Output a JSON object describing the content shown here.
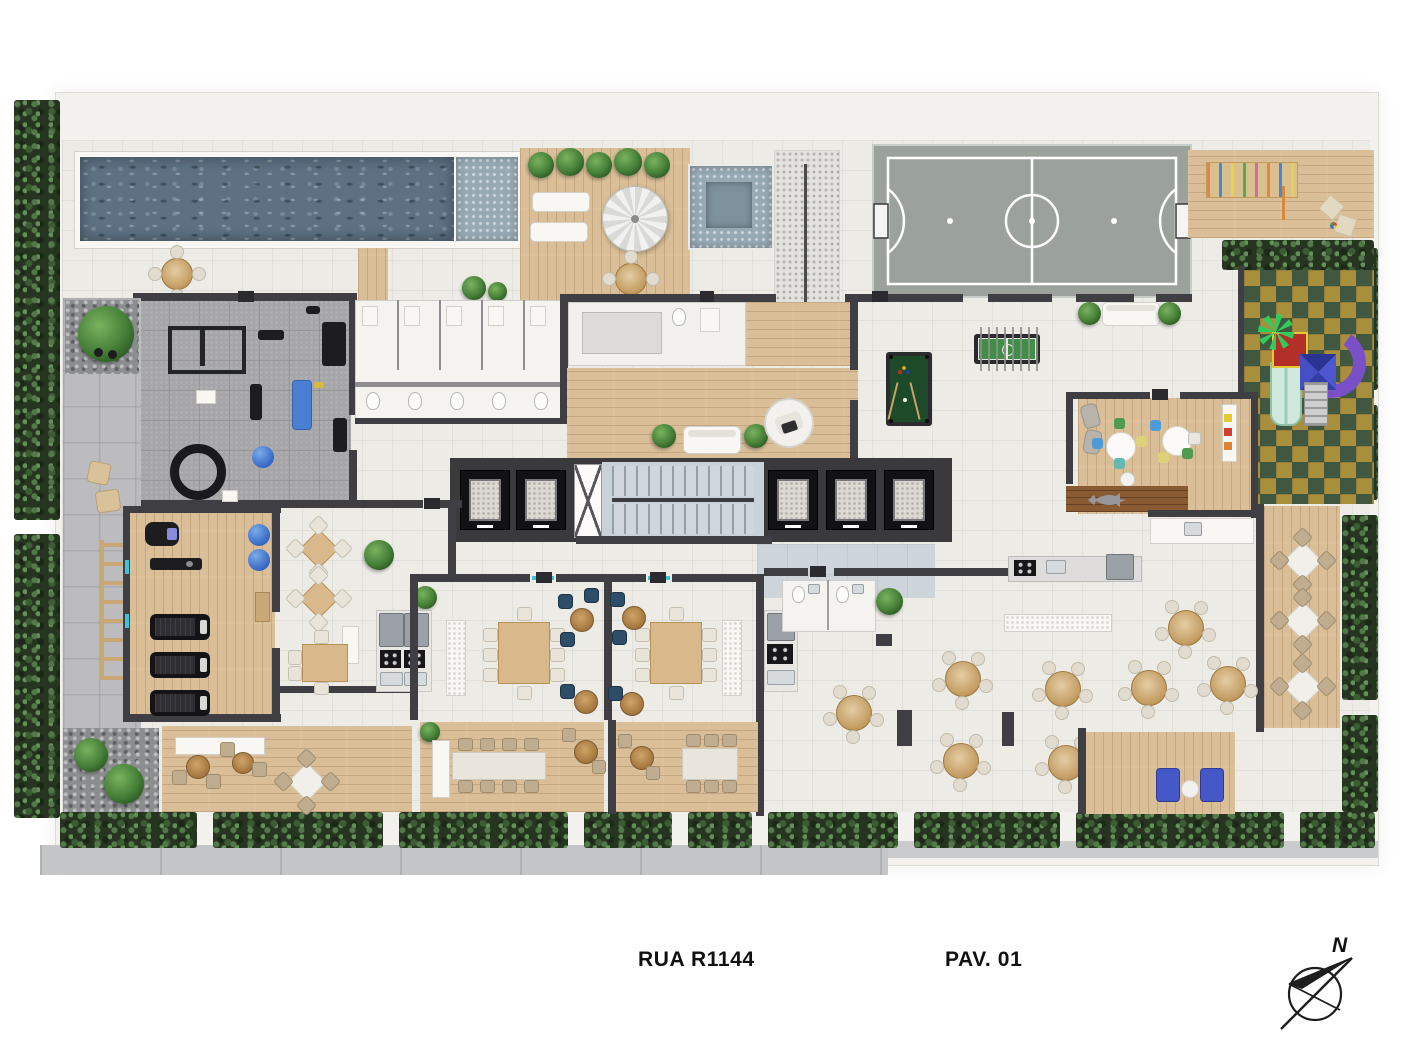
{
  "labels": {
    "street": "RUA R1144",
    "floor": "PAV. 01",
    "compass_north": "N"
  },
  "plan": {
    "type": "residential-amenities-floor-plan",
    "level": "ground floor",
    "areas": [
      "swimming-pool",
      "pool-shallow-ledge",
      "pool-deck",
      "sun-deck",
      "spa-pool",
      "access-ramp",
      "sports-court",
      "multipurpose-room",
      "playground",
      "planter",
      "gym",
      "outdoor-gym",
      "locker-rooms",
      "sauna",
      "lounge",
      "elevator-core",
      "stairwell",
      "entrance-lobby",
      "game-area",
      "billiards",
      "foosball",
      "kids-room",
      "cardio-room",
      "gourmet-room",
      "party-room-1",
      "party-room-2",
      "party-hall",
      "kitchen",
      "terrace",
      "wood-deck",
      "garden-hedge",
      "sidewalk"
    ]
  },
  "palette": {
    "background": "#ffffff",
    "tile": "#edebe6",
    "wood": "#d9be97",
    "wood_dark": "#8a5a33",
    "wall": "#3f3f43",
    "water": "#5d7183",
    "water_shallow": "#97aab4",
    "hedge": "#26351f",
    "court": "#9aa29b",
    "play_green": "#41573f",
    "play_yellow": "#a98e3e",
    "accent_blue": "#3668c4",
    "felt_green": "#1d4a28",
    "slide_mint": "#cfeadd",
    "slide_purple": "#7a50c8",
    "slide_red": "#b23028",
    "roof_blue": "#4650c4"
  }
}
